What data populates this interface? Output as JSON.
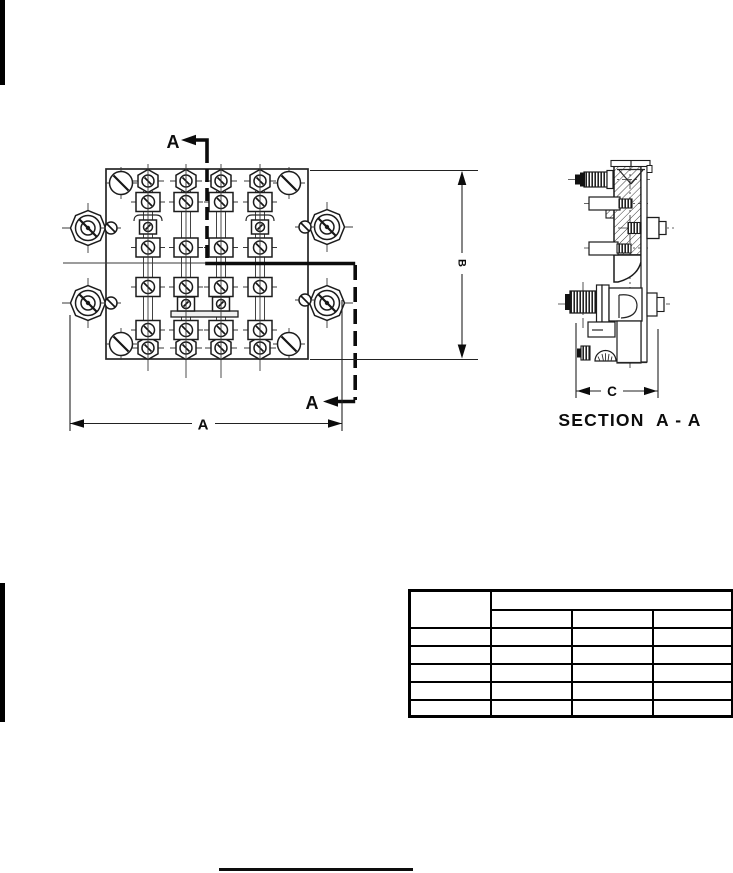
{
  "page": {
    "background": "#ffffff",
    "ink": "#000000"
  },
  "front_view": {
    "section_cut_label_top": "A",
    "section_cut_label_bottom": "A",
    "width_dimension_label": "A",
    "height_dimension_label": "B"
  },
  "section_view": {
    "depth_dimension_label": "C",
    "caption": "SECTION  A - A"
  },
  "table": {
    "header": {
      "corner": "",
      "group": "",
      "columns": [
        "",
        "",
        ""
      ]
    },
    "rows": [
      [
        "",
        "",
        "",
        ""
      ],
      [
        "",
        "",
        "",
        ""
      ],
      [
        "",
        "",
        "",
        ""
      ],
      [
        "",
        "",
        "",
        ""
      ],
      [
        "",
        "",
        "",
        ""
      ]
    ]
  }
}
